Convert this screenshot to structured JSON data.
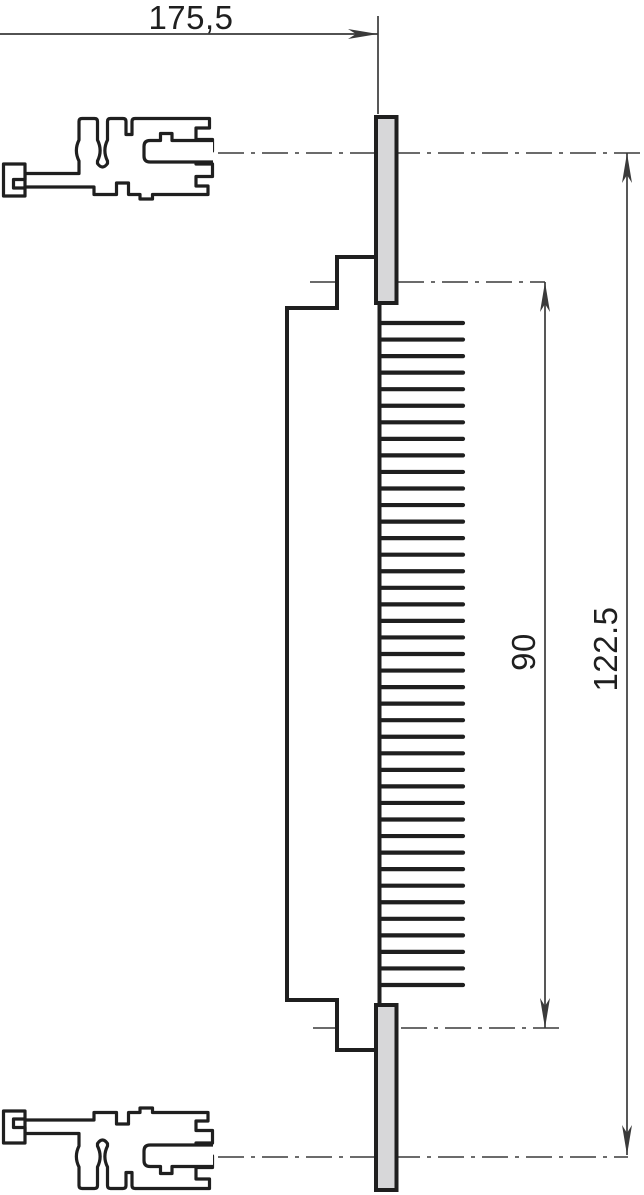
{
  "drawing": {
    "type": "technical-drawing",
    "description": "Side view of connector pin strip mounted between two extruded rail profiles",
    "line_color": "#1f1f1f",
    "thin_line_color": "#3a3a3a",
    "flange_fill_color": "#d7d7d9",
    "dimensions": {
      "width_label": "175,5",
      "pin_span_label": "90",
      "total_height_label": "122.5"
    },
    "pins": {
      "count": 41,
      "x_start": 380,
      "x_end": 463,
      "y_start": 323,
      "y_end": 985
    }
  }
}
